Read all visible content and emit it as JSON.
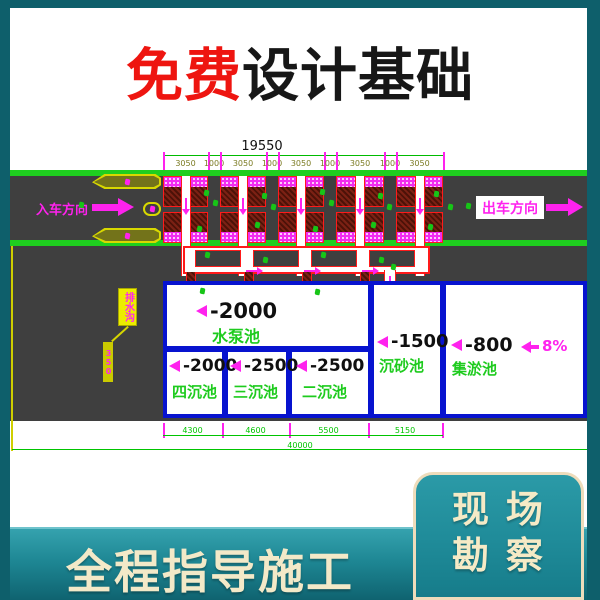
{
  "title": {
    "free": "免费",
    "rest": "设计基础"
  },
  "plan": {
    "top_dim": {
      "total": "19550",
      "segments": [
        "3050",
        "1000",
        "3050",
        "1000",
        "3050",
        "1000",
        "3050",
        "1000",
        "3050"
      ]
    },
    "entry_label": "入车方向",
    "exit_label": "出车方向",
    "callout": {
      "tag": "排水沟",
      "note": "350"
    },
    "pools": {
      "pump": {
        "depth": "-2000",
        "name": "水泵池"
      },
      "four": {
        "depth": "-2000",
        "name": "四沉池"
      },
      "three": {
        "depth": "-2500",
        "name": "三沉池"
      },
      "two": {
        "depth": "-2500",
        "name": "二沉池"
      },
      "sand": {
        "depth": "-1500",
        "name": "沉砂池"
      },
      "silt": {
        "depth": "-800",
        "name": "集淤池"
      }
    },
    "slope_label": "8%",
    "bottom_dim": {
      "segments": [
        "4300",
        "4600",
        "5500",
        "5150"
      ],
      "total": "40000"
    }
  },
  "footer": {
    "banner": "全程指导施工",
    "card": {
      "line1": "现 场",
      "line2": "勘 察"
    }
  },
  "colors": {
    "frame_teal": "#0e5f6b",
    "accent_red": "#ee1510",
    "cad_magenta": "#ff22ee",
    "cad_green": "#1ecb1e",
    "cad_blue": "#0713cf",
    "cad_yellow": "#d8d800",
    "cream": "#f5eac6"
  }
}
